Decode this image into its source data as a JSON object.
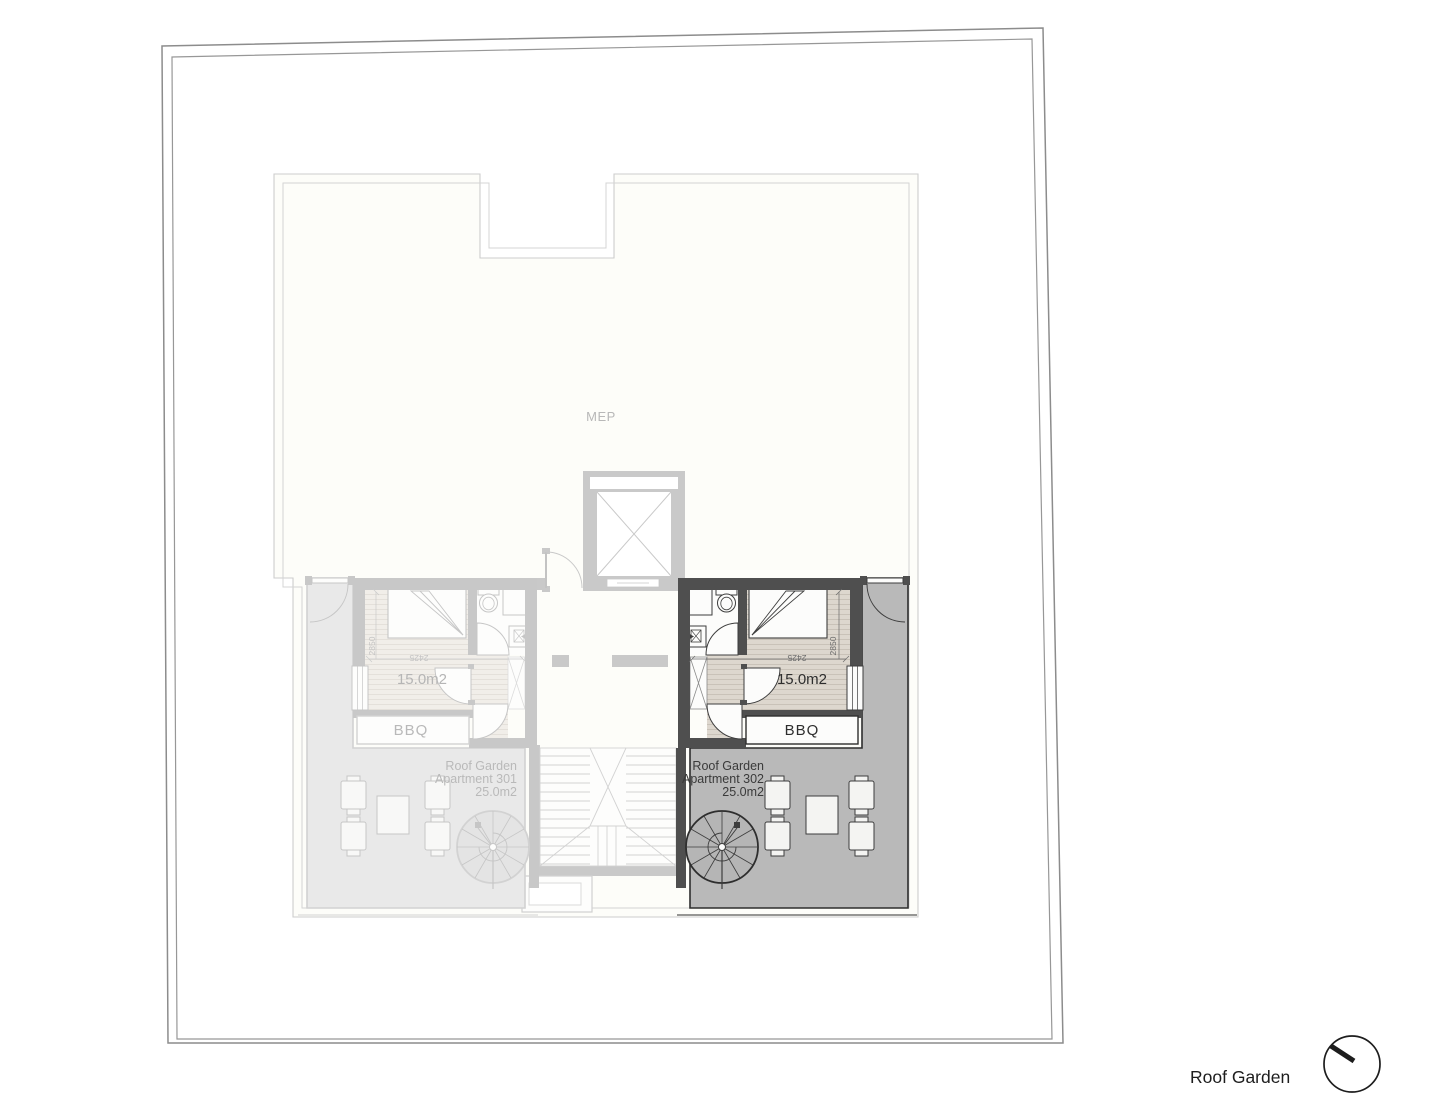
{
  "plan": {
    "mep_label": "MEP",
    "apartment_301": {
      "garden_label": [
        "Roof Garden",
        "Apartment 301",
        "25.0m2"
      ],
      "room_area_label": "15.0m2",
      "bbq_label": "BBQ",
      "dim_width": "2425",
      "dim_depth": "2850"
    },
    "apartment_302": {
      "garden_label": [
        "Roof Garden",
        "Apartment 302",
        "25.0m2"
      ],
      "room_area_label": "15.0m2",
      "bbq_label": "BBQ",
      "dim_width": "2425",
      "dim_depth": "2850"
    },
    "legend_title": "Roof Garden"
  },
  "colors": {
    "active_wall": "#4f4f4f",
    "active_terrace": "#b9b9b9",
    "ghost_wall": "#c8c8c8",
    "ghost_terrace": "#e9e9e9",
    "wood_floor": "#ddd7ce",
    "building_outline": "#cdcdcd",
    "site_boundary": "#8c8c8c",
    "label_text": "#2e2e2e"
  }
}
